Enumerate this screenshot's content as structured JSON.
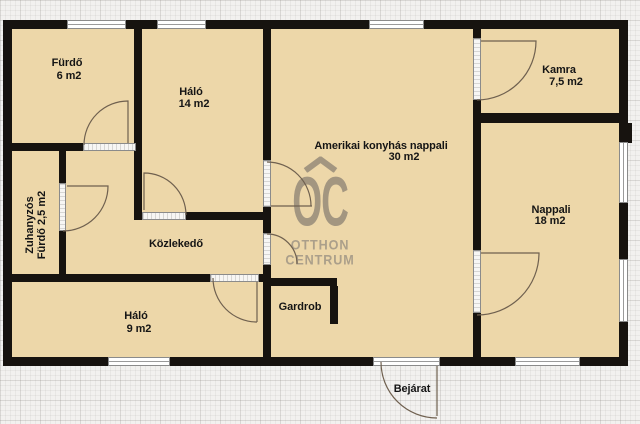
{
  "watermark": {
    "symbol": "OC",
    "word1": "OTTHON",
    "word2": "CENTRUM"
  },
  "rooms": {
    "furdo": {
      "name": "Fürdő",
      "area": "6 m2"
    },
    "halo14": {
      "name": "Háló",
      "area": "14 m2"
    },
    "amerikai": {
      "name": "Amerikai konyhás nappali",
      "area": "30 m2"
    },
    "kamra": {
      "name": "Kamra",
      "area": "7,5 m2"
    },
    "nappali": {
      "name": "Nappali",
      "area": "18 m2"
    },
    "zuhanyzos": {
      "name": "Zuhanyzós",
      "area": "Fürdő 2,5 m2"
    },
    "kozlekedo": {
      "name": "Közlekedő"
    },
    "halo9": {
      "name": "Háló",
      "area": "9 m2"
    },
    "gardrob": {
      "name": "Gardrob"
    },
    "bejarat": {
      "name": "Bejárat"
    }
  },
  "colors": {
    "room_fill": "#edd7a9",
    "wall": "#17130f",
    "paper": "#f2f1ef",
    "watermark": "#a39680"
  }
}
